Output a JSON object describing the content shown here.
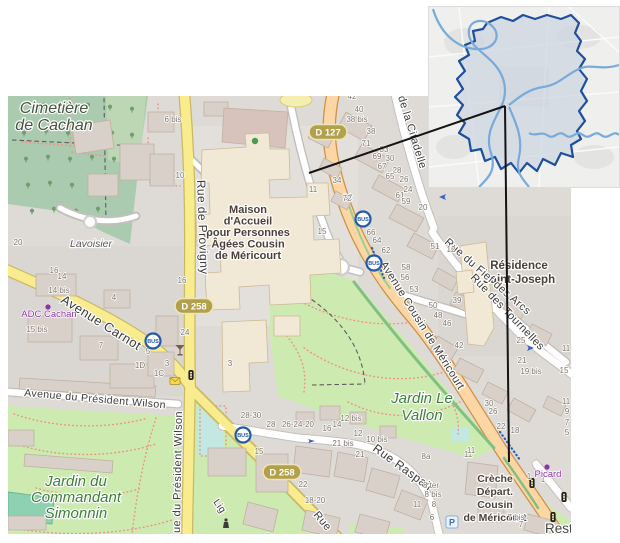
{
  "colors": {
    "base": "#dedbd7",
    "road_primary": "#fcd6a4",
    "road_primary_casing": "#cf9044",
    "road_secondary": "#f9ec8e",
    "road_secondary_casing": "#c9b868",
    "road_white": "#ffffff",
    "road_white_casing": "#c2c0bd",
    "park": "#cdebb0",
    "cemetery": "#aacbaf",
    "building": "#d9d0c9",
    "building_outline": "#bfb1a1",
    "building_special": "#f1e9d5",
    "pitch": "#8ed1b2",
    "playground": "#c3e8e2",
    "footpath_red": "#ef9288",
    "shield_bg": "#b3a04a",
    "shield_border": "#ece4c0",
    "poi_purple": "#8b35a3",
    "bus_blue": "#2458a8",
    "street_label": "#3a3a3a",
    "house_number": "#7d746a",
    "leader_line": "#141414"
  },
  "inset_map": {
    "region_fill": "#cdd5e0",
    "region_border": "#1e4f9f",
    "river": "#78aada"
  },
  "main_map": {
    "bus_label": "BUS",
    "parking_label": "P",
    "bus_stops": [
      [
        355,
        123
      ],
      [
        366,
        167
      ],
      [
        145,
        245
      ],
      [
        235,
        339
      ]
    ],
    "shields": [
      {
        "text": "D 127",
        "x": 320,
        "y": 36
      },
      {
        "text": "D 258",
        "x": 186,
        "y": 210
      },
      {
        "text": "D 258",
        "x": 274,
        "y": 376
      }
    ],
    "pois": [
      {
        "text": "Picard",
        "x": 540,
        "y": 371
      },
      {
        "text": "ADC Cachan",
        "x": 41,
        "y": 211
      }
    ],
    "place_labels": [
      {
        "name": "cemetery-label",
        "lines": [
          "Cimetière",
          "de Cachan"
        ],
        "x": 46,
        "y": 17,
        "lh": 17,
        "size": 16,
        "color": "#44543f",
        "italic": true
      },
      {
        "name": "lavoisier-label",
        "lines": [
          "Lavoisier"
        ],
        "x": 83,
        "y": 151,
        "lh": 12,
        "size": 10.5,
        "color": "#585858",
        "italic": true
      },
      {
        "name": "maison-accueil-label",
        "lines": [
          "Maison",
          "d'Accueil",
          "pour Personnes",
          "Âgées Cousin",
          "de Méricourt"
        ],
        "x": 240,
        "y": 117,
        "lh": 11.5,
        "size": 11,
        "color": "#4a4039",
        "bold": true
      },
      {
        "name": "residence-label",
        "lines": [
          "Résidence",
          "Saint-Joseph"
        ],
        "x": 511,
        "y": 173,
        "lh": 14,
        "size": 11.5,
        "color": "#4a4039",
        "bold": true
      },
      {
        "name": "jardin-vallon-label",
        "lines": [
          "Jardin Le",
          "Vallon"
        ],
        "x": 414,
        "y": 307,
        "lh": 17,
        "size": 15,
        "color": "#3c803c",
        "italic": true
      },
      {
        "name": "jardin-simonnin-label",
        "lines": [
          "Jardin du",
          "Commandant",
          "Simonnin"
        ],
        "x": 68,
        "y": 390,
        "lh": 16,
        "size": 15,
        "color": "#3c803c",
        "italic": true
      },
      {
        "name": "creche-label",
        "lines": [
          "Crèche",
          "Départ.",
          "Cousin",
          "de Méricourt"
        ],
        "x": 487,
        "y": 386,
        "lh": 13,
        "size": 10.5,
        "color": "#4a4039",
        "bold": true
      },
      {
        "name": "restaurant-label",
        "lines": [
          "Rest"
        ],
        "x": 537,
        "y": 437,
        "lh": 14,
        "size": 13.5,
        "color": "#454545",
        "anchor": "start"
      }
    ],
    "street_labels": [
      {
        "text": "Rue de Provigny",
        "x": 189,
        "y": 84,
        "rot": 88,
        "size": 12
      },
      {
        "text": "Avenue Carnot",
        "x": 52,
        "y": 206,
        "rot": 32,
        "size": 13
      },
      {
        "text": "Avenue du Président Wilson",
        "x": 16,
        "y": 300,
        "rot": 5,
        "size": 10.5
      },
      {
        "text": "ue du Président Wilson",
        "x": 172,
        "y": 437,
        "rot": -89,
        "size": 11
      },
      {
        "text": "Avenue Cousin de Méricourt",
        "x": 372,
        "y": 168,
        "rot": 58,
        "size": 11
      },
      {
        "text": "Rue du Fief des Arcs",
        "x": 436,
        "y": 147,
        "rot": 41,
        "size": 11
      },
      {
        "text": "Rue des Tournelles",
        "x": 462,
        "y": 182,
        "rot": 46,
        "size": 11
      },
      {
        "text": "Rue Raspail",
        "x": 364,
        "y": 354,
        "rot": 36,
        "size": 12
      },
      {
        "text": "de la Citadelle",
        "x": 390,
        "y": 1,
        "rot": 73,
        "size": 11
      },
      {
        "text": "Rue",
        "x": 305,
        "y": 419,
        "rot": 50,
        "size": 11
      },
      {
        "text": "Lig",
        "x": 205,
        "y": 406,
        "rot": 55,
        "size": 10
      }
    ],
    "house_numbers": [
      [
        "6 bis",
        165,
        26
      ],
      [
        "10",
        172,
        82
      ],
      [
        "20",
        10,
        149
      ],
      [
        "42",
        344,
        3
      ],
      [
        "40",
        351,
        16
      ],
      [
        "38 bis",
        349,
        26
      ],
      [
        "38",
        363,
        38
      ],
      [
        "71",
        358,
        50
      ],
      [
        "33",
        376,
        56
      ],
      [
        "69",
        369,
        63
      ],
      [
        "30",
        382,
        65
      ],
      [
        "67",
        374,
        73
      ],
      [
        "28",
        389,
        77
      ],
      [
        "65",
        382,
        83
      ],
      [
        "26",
        396,
        86
      ],
      [
        "24",
        400,
        96
      ],
      [
        "61",
        392,
        102
      ],
      [
        "59",
        398,
        108
      ],
      [
        "20",
        415,
        114
      ],
      [
        "34",
        329,
        87
      ],
      [
        "32",
        340,
        104
      ],
      [
        "11",
        305,
        96
      ],
      [
        "72",
        339,
        105
      ],
      [
        "15",
        314,
        138
      ],
      [
        "66",
        363,
        139
      ],
      [
        "64",
        369,
        147
      ],
      [
        "62",
        378,
        157
      ],
      [
        "58",
        398,
        174
      ],
      [
        "56",
        397,
        184
      ],
      [
        "53",
        406,
        196
      ],
      [
        "51",
        427,
        153
      ],
      [
        "12",
        443,
        156
      ],
      [
        "39",
        449,
        207
      ],
      [
        "50",
        425,
        212
      ],
      [
        "48",
        430,
        222
      ],
      [
        "46",
        439,
        230
      ],
      [
        "42",
        451,
        252
      ],
      [
        "25",
        513,
        247
      ],
      [
        "21",
        514,
        267
      ],
      [
        "19 bis",
        523,
        278
      ],
      [
        "15",
        556,
        277
      ],
      [
        "11",
        558,
        255
      ],
      [
        "16",
        174,
        187
      ],
      [
        "24",
        177,
        239
      ],
      [
        "3",
        159,
        270
      ],
      [
        "1C",
        151,
        280
      ],
      [
        "1D",
        132,
        272
      ],
      [
        "3",
        222,
        270
      ],
      [
        "16",
        46,
        177
      ],
      [
        "14",
        54,
        183
      ],
      [
        "14 bis",
        51,
        197
      ],
      [
        "15 bis",
        29,
        236
      ],
      [
        "4",
        106,
        204
      ],
      [
        "7",
        93,
        252
      ],
      [
        "5",
        140,
        258
      ],
      [
        "26-24-20",
        290,
        331
      ],
      [
        "16",
        319,
        335
      ],
      [
        "14",
        329,
        331
      ],
      [
        "12 bis",
        343,
        325
      ],
      [
        "12",
        350,
        340
      ],
      [
        "10 bis",
        369,
        346
      ],
      [
        "21 bis",
        335,
        350
      ],
      [
        "21",
        352,
        361
      ],
      [
        "8a",
        418,
        363
      ],
      [
        "8 ter",
        423,
        392
      ],
      [
        "8 bis",
        425,
        401
      ],
      [
        "11",
        409,
        411
      ],
      [
        "8",
        426,
        411
      ],
      [
        "6",
        424,
        424
      ],
      [
        "22",
        295,
        391
      ],
      [
        "18-20",
        307,
        407
      ],
      [
        "11",
        460,
        361
      ],
      [
        "28-30",
        243,
        322
      ],
      [
        "28",
        263,
        331
      ],
      [
        "15",
        251,
        358
      ],
      [
        "30",
        481,
        310
      ],
      [
        "26",
        485,
        318
      ],
      [
        "22",
        493,
        333
      ],
      [
        "18",
        507,
        337
      ],
      [
        "11",
        463,
        357
      ],
      [
        "1",
        521,
        383
      ],
      [
        "7 bis",
        508,
        424
      ],
      [
        "7",
        513,
        431
      ],
      [
        "1",
        535,
        386
      ],
      [
        "11",
        558,
        308
      ],
      [
        "9",
        559,
        318
      ],
      [
        "7",
        559,
        329
      ],
      [
        "5",
        559,
        339
      ]
    ]
  }
}
